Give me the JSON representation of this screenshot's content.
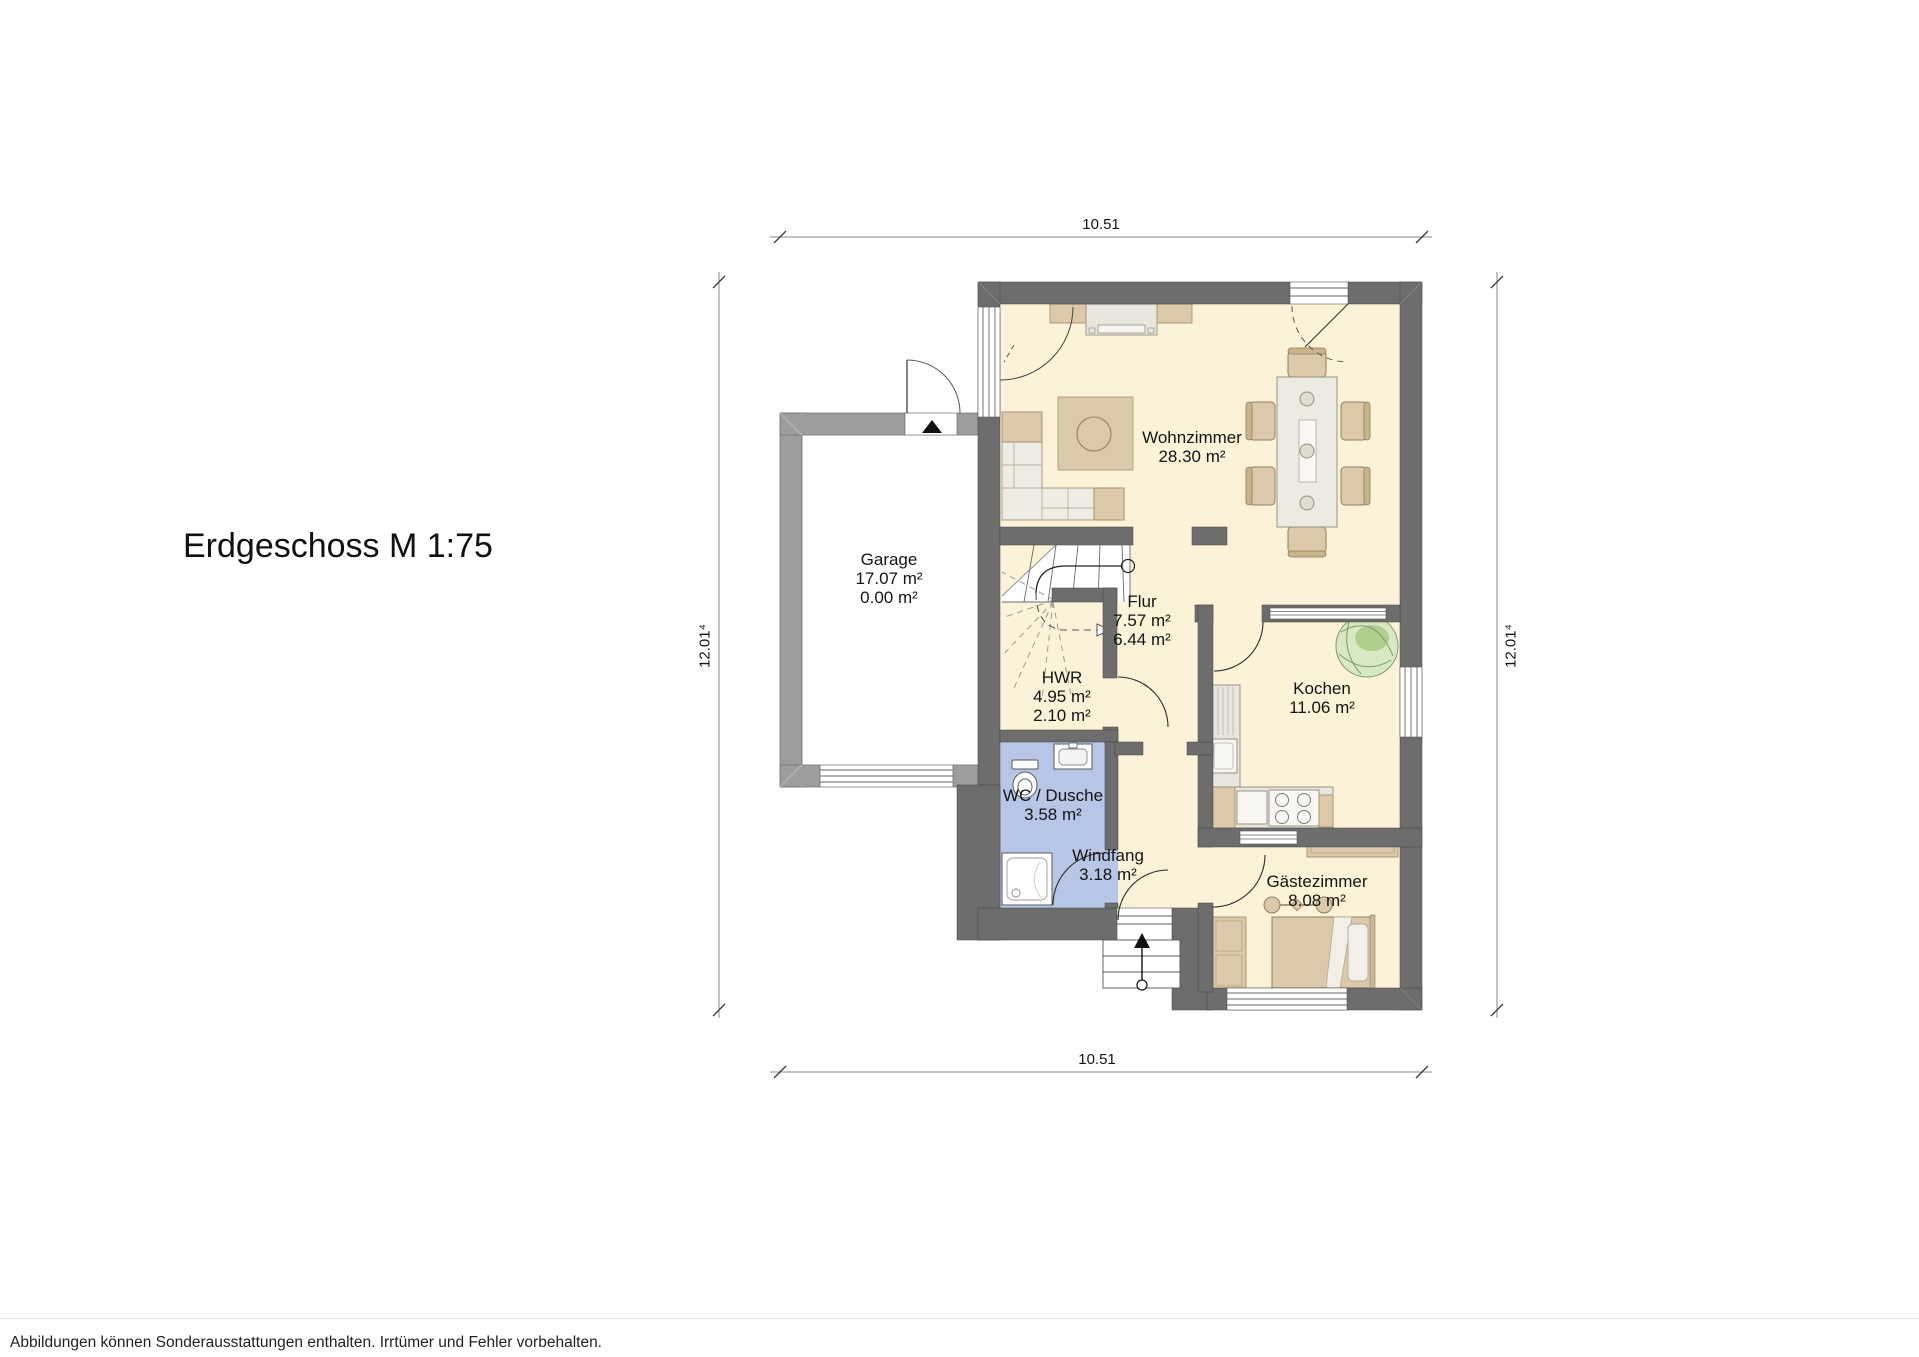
{
  "title": "Erdgeschoss M 1:75",
  "footer": "Abbildungen können Sonderausstattungen enthalten. Irrtümer und Fehler vorbehalten.",
  "dimensions": {
    "top": "10.51",
    "bottom": "10.51",
    "left": "12.01⁴",
    "right": "12.01⁴"
  },
  "rooms": [
    {
      "key": "garage",
      "name": "Garage",
      "areas": [
        "17.07 m²",
        "0.00 m²"
      ]
    },
    {
      "key": "wohnzimmer",
      "name": "Wohnzimmer",
      "areas": [
        "28.30 m²"
      ]
    },
    {
      "key": "flur",
      "name": "Flur",
      "areas": [
        "7.57 m²",
        "6.44 m²"
      ]
    },
    {
      "key": "hwr",
      "name": "HWR",
      "areas": [
        "4.95 m²",
        "2.10 m²"
      ]
    },
    {
      "key": "kochen",
      "name": "Kochen",
      "areas": [
        "11.06 m²"
      ]
    },
    {
      "key": "wc-dusche",
      "name": "WC / Dusche",
      "areas": [
        "3.58 m²"
      ]
    },
    {
      "key": "windfang",
      "name": "Windfang",
      "areas": [
        "3.18 m²"
      ]
    },
    {
      "key": "gaestezimmer",
      "name": "Gästezimmer",
      "areas": [
        "8.08 m²"
      ]
    }
  ],
  "colors": {
    "wall": "#6d6d6d",
    "garage_wall": "#9d9d9d",
    "floor": "#fbf2d8",
    "wet_floor": "#b7c6e7",
    "furniture_tan": "#dbc9a9",
    "furniture_light": "#eceae3",
    "plant_green": "#cfe2b0"
  }
}
